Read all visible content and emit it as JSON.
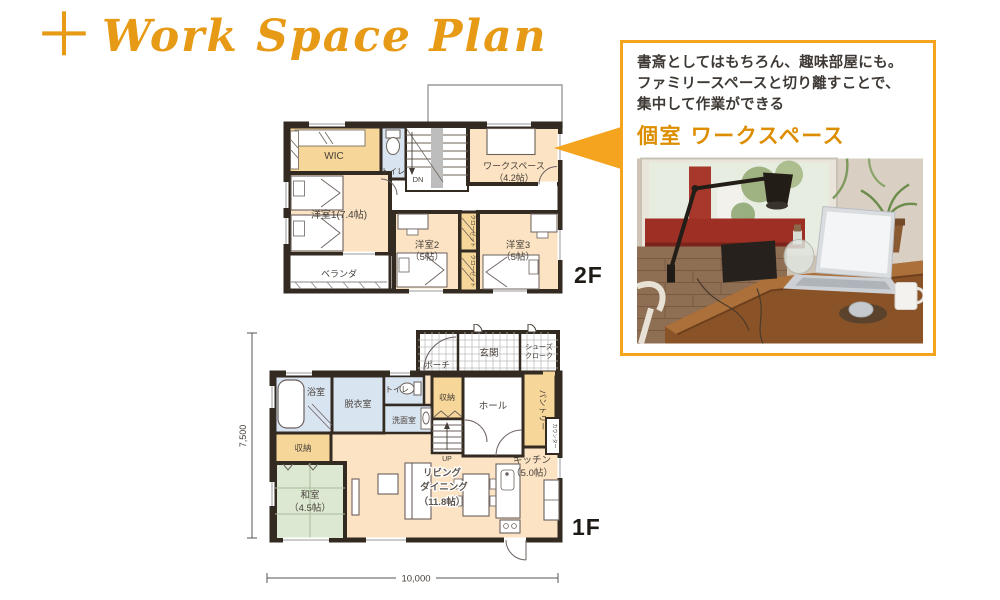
{
  "title": {
    "plus": "＋",
    "text": "Work Space Plan"
  },
  "callout": {
    "line1": "書斎としてはもちろん、趣味部屋にも。",
    "line2": "ファミリースペースと切り離すことで、",
    "line3": "集中して作業ができる",
    "heading": "個室 ワークスペース"
  },
  "floor2": {
    "floor_label": "2F",
    "wic": "WIC",
    "toilet": "トイレ",
    "stairs_down": "DN",
    "workspace_name": "ワークスペース",
    "workspace_size": "（4.2帖）",
    "bedroom1": "洋室1(7.4帖)",
    "bedroom2_name": "洋室2",
    "bedroom2_size": "（5帖）",
    "bedroom3_name": "洋室3",
    "bedroom3_size": "（5帖）",
    "closet1": "クローゼット",
    "closet2": "クローゼット",
    "veranda": "ベランダ"
  },
  "floor1": {
    "floor_label": "1F",
    "porch": "ポーチ",
    "entrance": "玄関",
    "shoes1": "シューズ",
    "shoes2": "クローク",
    "bathroom": "浴室",
    "dressing": "脱衣室",
    "toilet": "トイレ",
    "washroom": "洗面室",
    "storage_top": "収納",
    "hall": "ホール",
    "pantry": "パントリー",
    "counter": "カウンター",
    "stairs_up": "UP",
    "storage_left": "収納",
    "washitsu_name": "和室",
    "washitsu_size": "（4.5帖）",
    "living1": "リビング",
    "living2": "ダイニング",
    "living3": "（11.8帖）",
    "kitchen_name": "キッチン",
    "kitchen_size": "（5.0帖）",
    "dim_w": "10,000",
    "dim_h": "7,500"
  },
  "colors": {
    "accent_orange": "#E79A15",
    "callout_border": "#F4A41F",
    "heading_orange": "#DD8E00",
    "wall": "#332A22",
    "room_beige": "#FBE3C4",
    "room_orange": "#F6D699",
    "room_blue": "#D9E4F1",
    "tatami_green": "#DCE8D2"
  }
}
